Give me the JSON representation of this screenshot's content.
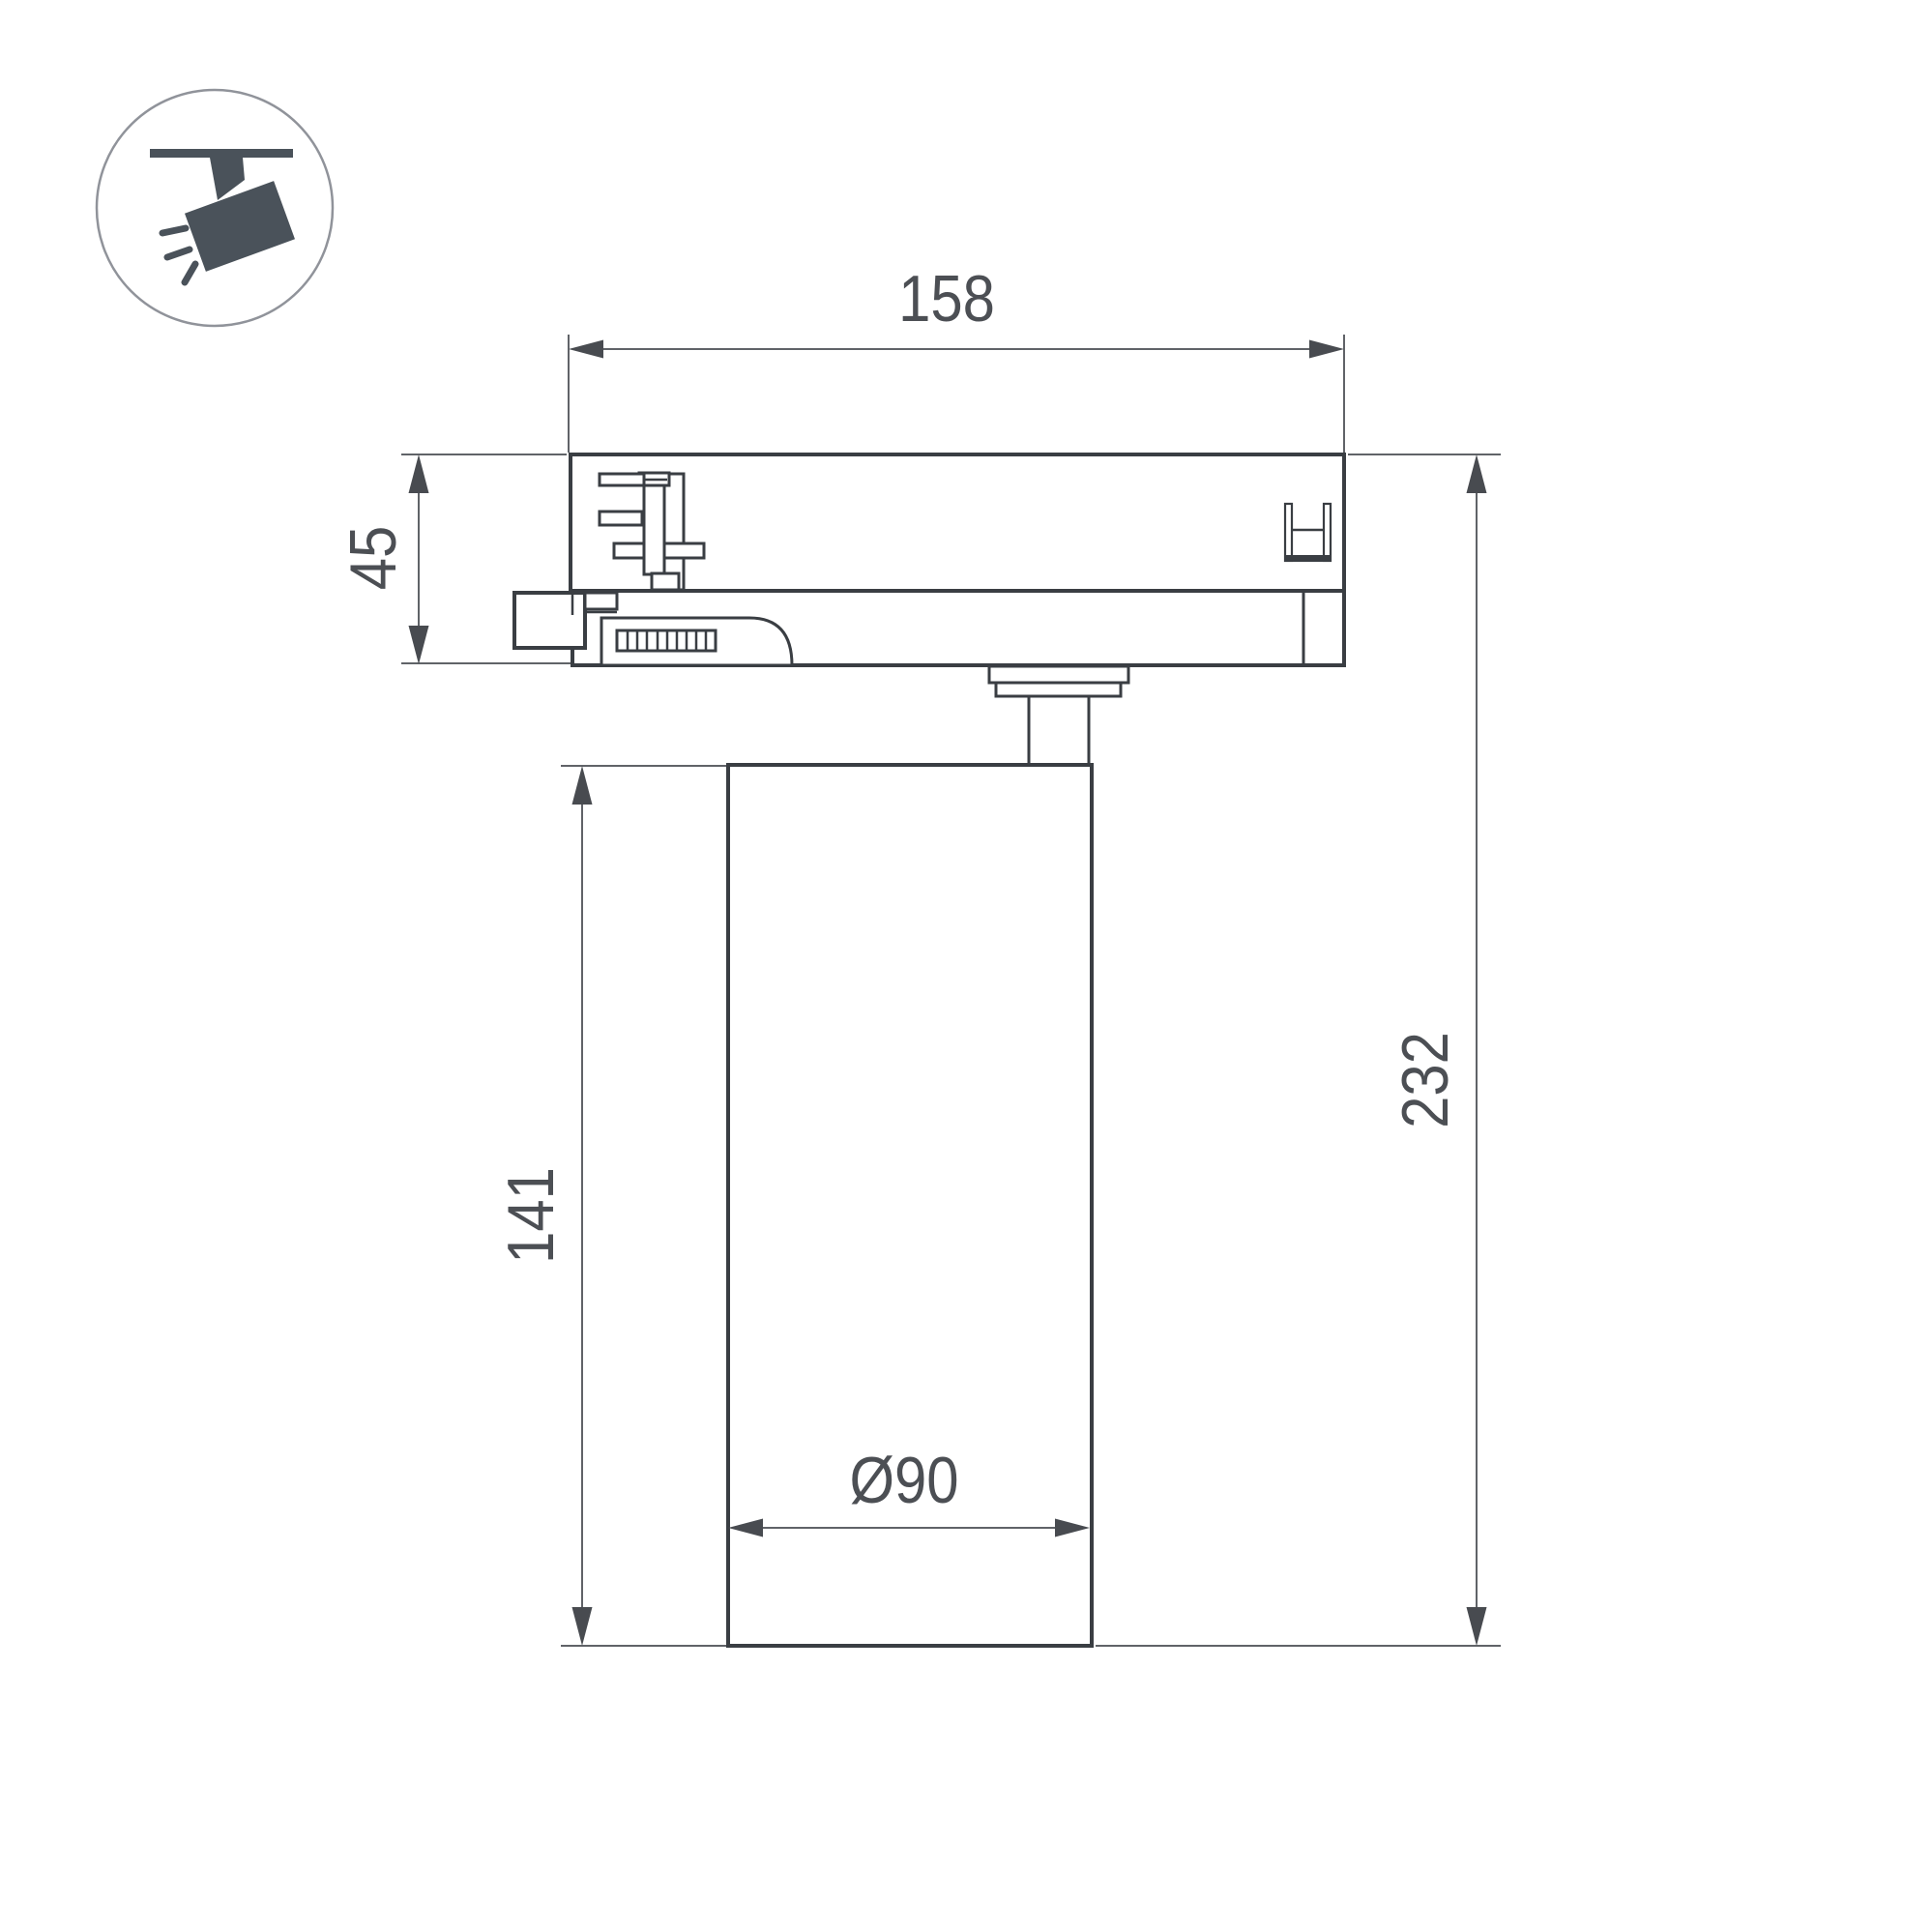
{
  "icon": {
    "name": "track-spotlight",
    "style": "circular-outline-pictogram"
  },
  "dimension_labels": {
    "adapter_width": "158",
    "adapter_height": "45",
    "body_height": "141",
    "total_height": "232",
    "body_diameter": "Ø90"
  },
  "colors": {
    "background": "#ffffff",
    "outline": "#3a3e43",
    "dimension_line": "#606368",
    "dimension_text": "#4c4f54",
    "icon_fill": "#4a525a"
  }
}
